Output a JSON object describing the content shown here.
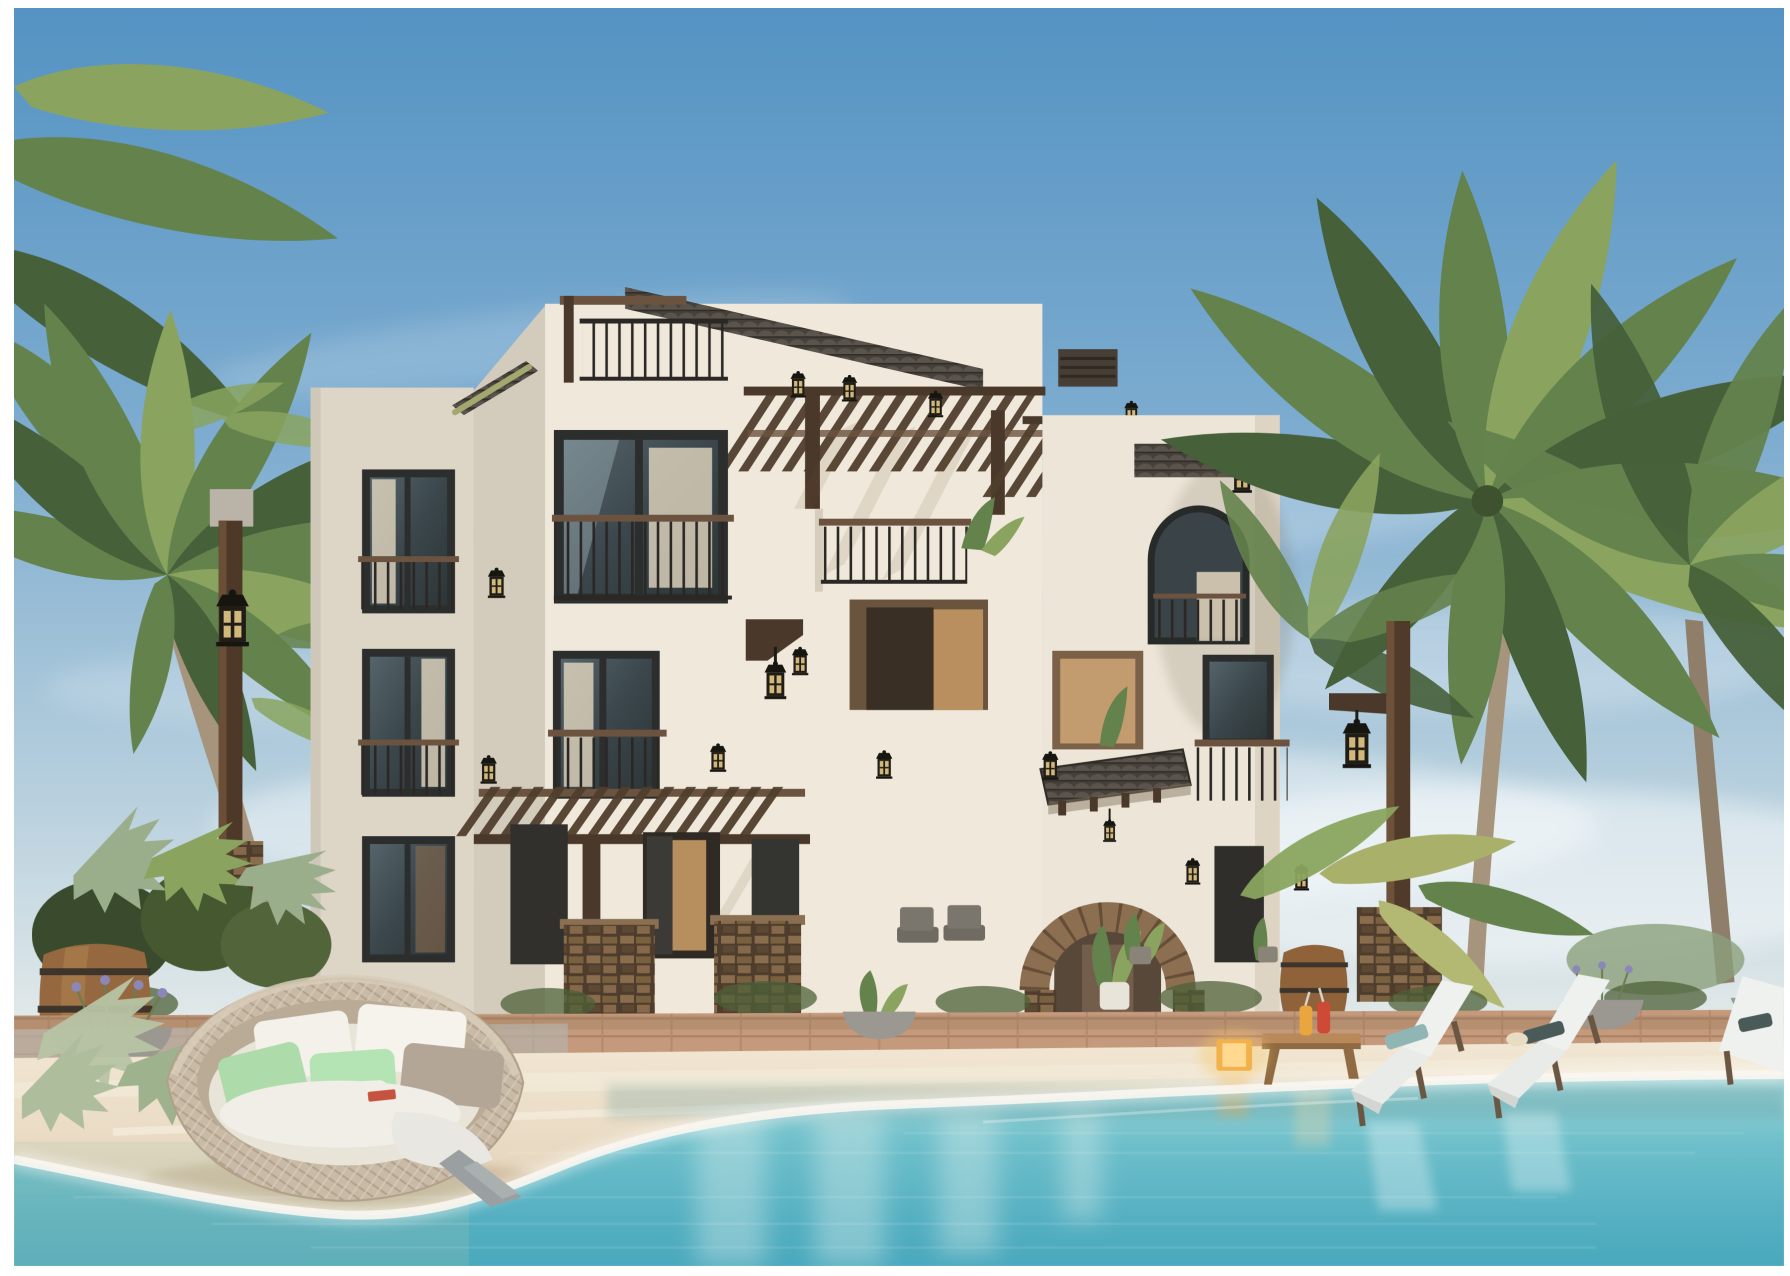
{
  "meta": {
    "alt": "Sunny photorealistic rendering of a three-storey whitewashed beach villa with dark timber pergolas and railings, a stone entrance arch, palm trees, a clipped hedgerow, white sand shore and a turquoise lagoon pool with a round rattan daybed and white sun loungers at the water's edge"
  },
  "palette": {
    "sky_top": "#5493c3",
    "sky_horizon": "#eceeec",
    "water_shallow": "#a6d6d8",
    "water_deep": "#4aa9bd",
    "sand": "#eadcc6",
    "sand_foam": "#f8f3ea",
    "facade_light": "#f0e9db",
    "facade_shade": "#ddd5c6",
    "wood_dark": "#4a382a",
    "wood_mid": "#6b5340",
    "metal_dark": "#2a2724",
    "roof_tile": "#45403a",
    "hedge_dark": "#2f3d22",
    "hedge_light": "#4e6038",
    "palm_dark": "#46603a",
    "palm_mid": "#64824c",
    "palm_light": "#8aa45f",
    "palm_grey": "#9aae8b",
    "palm_trunk": "#a6947d",
    "stone": "#8b6f50",
    "paver": "#c59a7c",
    "lantern_glow": "#e2c584",
    "glow_cube": "#f2b14b",
    "cushion_green": "#aedbaa",
    "cushion_taupe": "#b3a696",
    "towel_white": "#eff1ee",
    "barrel_wood": "#96683f"
  },
  "scene": {
    "setting": "daytime waterfront resort villa",
    "building": {
      "label": "three-storey whitewashed villa",
      "storeys": 3,
      "elements": [
        "rooftop terrace with railing",
        "timber pergolas",
        "dark framed windows",
        "juliet balconies",
        "stone entrance arch",
        "clay tile awning",
        "wall lanterns",
        "arched tower window",
        "louvred vent"
      ]
    },
    "vegetation": {
      "palm_trees": 4,
      "hedge": "clipped green hedgerow along the terrace",
      "planters": [
        "stone bowls with lavender",
        "palmetto fans",
        "potted tropical plants"
      ]
    },
    "waterfront": {
      "water": "turquoise lagoon pool",
      "beach": "white sand shore with foam edge"
    },
    "furniture": {
      "daybed": {
        "label": "round rattan daybed",
        "cushions": 7,
        "throw": "grey throw blanket"
      },
      "loungers": {
        "count": 3,
        "label": "white cushioned sun loungers"
      },
      "side_table": {
        "label": "low wooden drinks table",
        "drinks": 2
      },
      "glow_lamp": {
        "label": "amber cube lantern"
      },
      "barrels": 2,
      "street_lamps": 2,
      "planter_bowls": 4,
      "terrace_chairs": 2
    }
  }
}
